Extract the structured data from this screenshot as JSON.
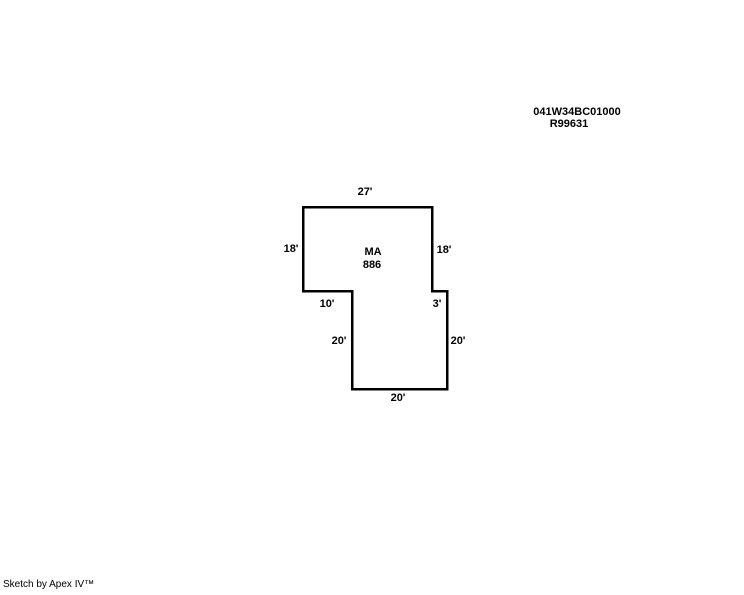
{
  "page": {
    "background_color": "#ffffff",
    "line_color": "#000000",
    "text_color": "#000000"
  },
  "parcel": {
    "id": "041W34BC01000",
    "alt_id": "R99631"
  },
  "sketch": {
    "area": {
      "code": "MA",
      "size": "886"
    },
    "outline": {
      "color": "#000000",
      "stroke_width": 2.5,
      "vertices": [
        [
          303,
          207
        ],
        [
          432,
          207
        ],
        [
          432,
          291
        ],
        [
          447,
          291
        ],
        [
          447,
          389
        ],
        [
          352,
          389
        ],
        [
          352,
          291
        ],
        [
          303,
          291
        ]
      ]
    },
    "dimensions": [
      {
        "label": "27'",
        "side": "top",
        "x": 365,
        "y": 192
      },
      {
        "label": "18'",
        "side": "left-upper",
        "x": 291,
        "y": 249
      },
      {
        "label": "18'",
        "side": "right-upper",
        "x": 444,
        "y": 250
      },
      {
        "label": "10'",
        "side": "step-bottom-left",
        "x": 327,
        "y": 304
      },
      {
        "label": "3'",
        "side": "step-bottom-right",
        "x": 437,
        "y": 304
      },
      {
        "label": "20'",
        "side": "left-lower",
        "x": 339,
        "y": 341
      },
      {
        "label": "20'",
        "side": "right-lower",
        "x": 458,
        "y": 341
      },
      {
        "label": "20'",
        "side": "bottom",
        "x": 398,
        "y": 398
      }
    ]
  },
  "footer": {
    "credit": "Sketch by Apex IV™"
  }
}
